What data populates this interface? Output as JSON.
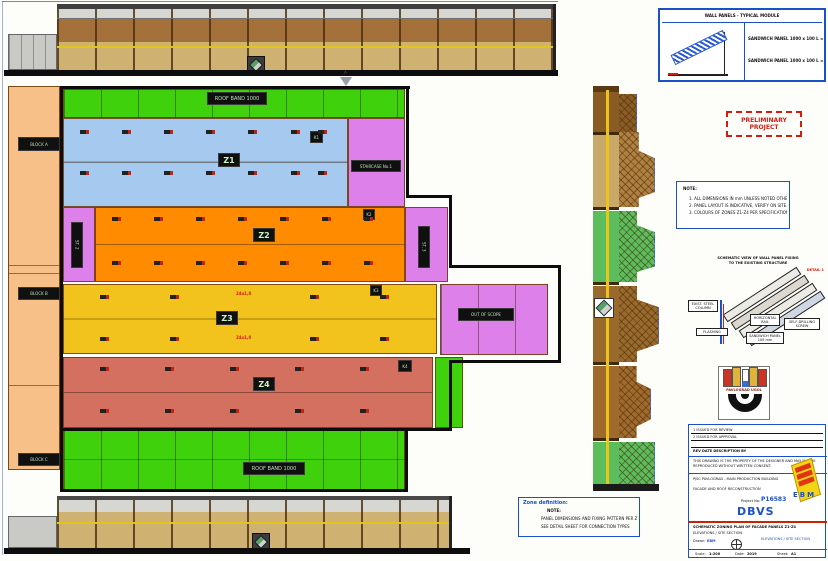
{
  "stamp": {
    "line1": "PRELIMINARY",
    "line2": "PROJECT"
  },
  "spec": {
    "header": "WALL PANELS - TYPICAL MODULE",
    "line1": "SANDWICH PANEL 1000 x 100   L = 12.0 m",
    "line2": "SANDWICH PANEL 1000 x 100   L = 10.0 m"
  },
  "note1": {
    "title": "NOTE:",
    "lines": [
      "1. ALL DIMENSIONS IN mm UNLESS NOTED OTHERWISE.",
      "2. PANEL LAYOUT IS INDICATIVE, VERIFY ON SITE.",
      "3. COLOURS OF ZONES Z1-Z4 PER SPECIFICATION."
    ]
  },
  "detail": {
    "title1": "SCHEMATIC VIEW OF WALL PANEL FIXING",
    "title2": "TO THE EXISTING STRUCTURE",
    "ref": "DETAIL 1",
    "callouts": [
      "EXIST. STEEL COLUMN",
      "HORIZONTAL RAIL",
      "SANDWICH PANEL 100 mm",
      "SELF-DRILLING SCREW",
      "FLASHING"
    ]
  },
  "note2": {
    "title": "Zone definition:",
    "note": "NOTE:",
    "lines": [
      "PANEL DIMENSIONS AND FIXING PATTERN PER ZONE",
      "SEE DETAIL SHEET FOR CONNECTION TYPES"
    ]
  },
  "plan": {
    "zone_labels": {
      "z1": "Z1",
      "z2": "Z2",
      "z3": "Z3",
      "z4": "Z4"
    },
    "green_top": "ROOF BAND 1000",
    "green_bottom": "ROOF BAND 1000",
    "p1": "STAIRCASE No.1",
    "p2": "ST. 2",
    "p3": "ST. 3",
    "annex": "OUT OF SCOPE",
    "left_blocks": [
      "BLOCK A",
      "BLOCK B",
      "BLOCK C"
    ],
    "tags": {
      "k1": "K1",
      "k2": "K2",
      "k3": "K3",
      "k4": "K4"
    },
    "dims": {
      "d1": "24x1,0",
      "d2": "24x1,0"
    },
    "section_mark": "A"
  },
  "logo": {
    "brand": "PAVLOGRAD UGOL",
    "ebm": "EBM"
  },
  "titleblock": {
    "rev_header": "REV   DATE   DESCRIPTION          BY",
    "rev_rows": [
      {
        "no": "1",
        "text": "ISSUED FOR REVIEW"
      },
      {
        "no": "2",
        "text": "ISSUED FOR APPROVAL"
      }
    ],
    "para": "THIS DRAWING IS THE PROPERTY OF THE DESIGNER AND MAY NOT BE REPRODUCED WITHOUT WRITTEN CONSENT.",
    "client_lines": "PJSC PAVLOGRAD - MAIN PRODUCTION BUILDING",
    "address": "FACADE AND ROOF RECONSTRUCTION",
    "project_no_label": "Project No:",
    "project_no": "P16583",
    "code": "DBVS",
    "desc1": "SCHEMATIC ZONING PLAN OF FACADE PANELS Z1-Z4",
    "desc2": "ELEVATIONS / SITE SECTION",
    "scale_label": "Scale:",
    "scale": "1:200",
    "date_label": "Date:",
    "date": "2019",
    "sheet_label": "Sheet:",
    "sheet": "A1",
    "drawn_label": "Drawn:",
    "drawn": "EBM"
  },
  "colors": {
    "green": "#3fd20c",
    "blue_zone": "#a6c9ef",
    "orange_zone": "#ff8c00",
    "yellow_zone": "#f2c21d",
    "red_zone": "#d4705f",
    "purple_zone": "#de80ea",
    "peach": "#f7c089",
    "accent_blue": "#1a50c8",
    "accent_red": "#d51c10"
  }
}
